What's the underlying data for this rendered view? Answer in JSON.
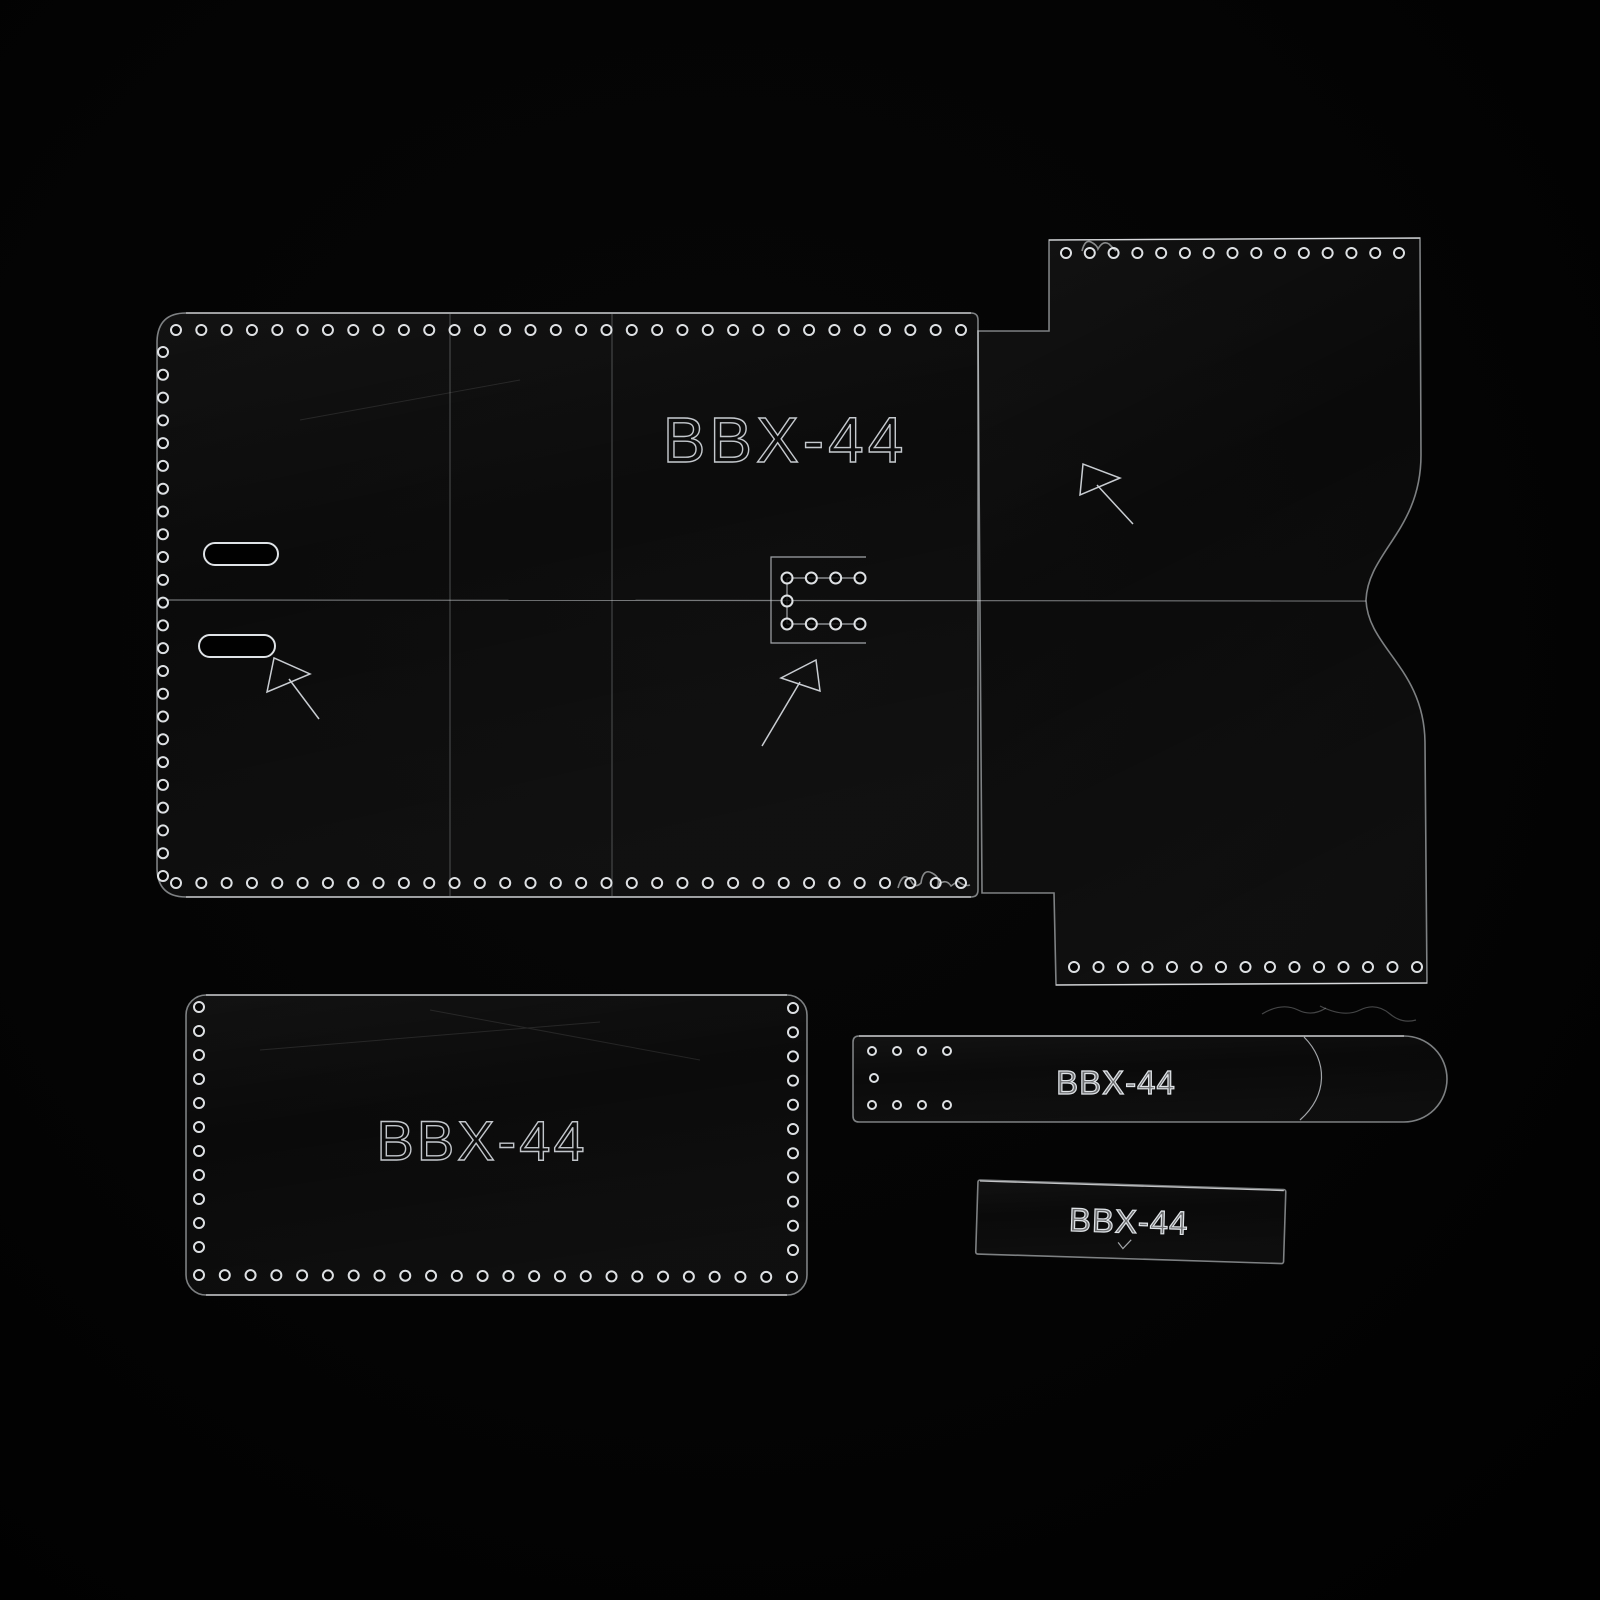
{
  "scene": {
    "description": "Clear acrylic leathercraft wallet template set photographed on black velvet",
    "background_color": "#020202",
    "acrylic_edge_color": "#dee3e8",
    "engraving_color": "#c9cdd2",
    "hole_ring_color": "#e9ecef"
  },
  "part_code": "BBX-44",
  "pieces": {
    "main_body": {
      "name": "main wallet body template",
      "label": "BBX-44",
      "slot_count": 2,
      "hole_rows": [
        {
          "x1": 176,
          "y1": 330,
          "x2": 961,
          "y2": 330,
          "count": 32,
          "r": 5
        },
        {
          "x1": 163,
          "y1": 352,
          "x2": 163,
          "y2": 876,
          "count": 24,
          "r": 5
        },
        {
          "x1": 176,
          "y1": 883,
          "x2": 961,
          "y2": 883,
          "count": 32,
          "r": 5
        }
      ],
      "buckle_hole_rows": [
        {
          "x1": 787,
          "y1": 578,
          "x2": 860,
          "y2": 578,
          "count": 4,
          "r": 5.5
        },
        {
          "x1": 787,
          "y1": 601,
          "x2": 787,
          "y2": 601,
          "count": 1,
          "r": 5.5
        },
        {
          "x1": 787,
          "y1": 624,
          "x2": 860,
          "y2": 624,
          "count": 4,
          "r": 5.5
        }
      ]
    },
    "side_panel": {
      "name": "side panel template with thumb notch",
      "hole_rows": [
        {
          "x1": 1066,
          "y1": 253,
          "x2": 1399,
          "y2": 253,
          "count": 15,
          "r": 5
        },
        {
          "x1": 1074,
          "y1": 967,
          "x2": 1417,
          "y2": 967,
          "count": 15,
          "r": 5
        }
      ]
    },
    "pocket": {
      "name": "pocket template",
      "label": "BBX-44",
      "hole_rows": [
        {
          "x1": 199,
          "y1": 1007,
          "x2": 199,
          "y2": 1247,
          "count": 11,
          "r": 5
        },
        {
          "x1": 793,
          "y1": 1008,
          "x2": 793,
          "y2": 1250,
          "count": 11,
          "r": 5
        },
        {
          "x1": 199,
          "y1": 1275,
          "x2": 792,
          "y2": 1277,
          "count": 24,
          "r": 5
        }
      ]
    },
    "strap": {
      "name": "strap template with rounded tip",
      "label": "BBX-44",
      "hole_rows": [
        {
          "x1": 20,
          "y1": 16,
          "x2": 95,
          "y2": 16,
          "count": 4,
          "r": 4
        },
        {
          "x1": 22,
          "y1": 43,
          "x2": 22,
          "y2": 43,
          "count": 1,
          "r": 4
        },
        {
          "x1": 20,
          "y1": 70,
          "x2": 95,
          "y2": 70,
          "count": 4,
          "r": 4
        }
      ]
    },
    "small_tab": {
      "name": "small tab template",
      "label": "BBX-44"
    }
  }
}
